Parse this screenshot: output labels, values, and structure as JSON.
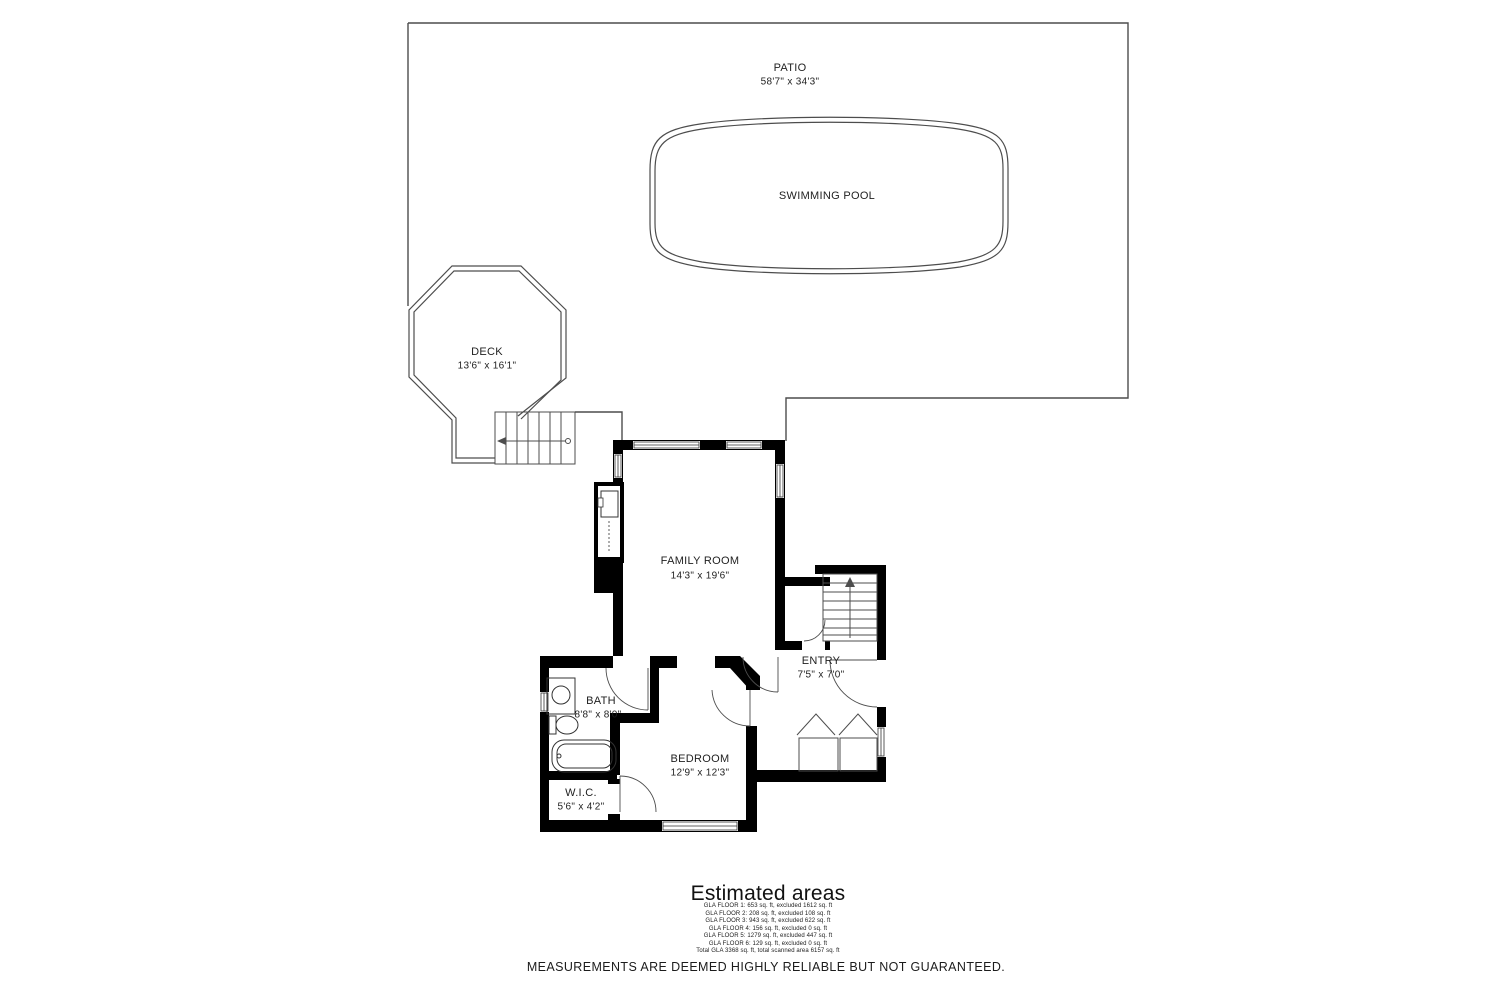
{
  "plan": {
    "patio": {
      "name": "PATIO",
      "dims": "58'7\" x 34'3\""
    },
    "pool": {
      "name": "SWIMMING POOL"
    },
    "deck": {
      "name": "DECK",
      "dims": "13'6\" x 16'1\""
    },
    "family_room": {
      "name": "FAMILY ROOM",
      "dims": "14'3\" x 19'6\""
    },
    "entry": {
      "name": "ENTRY",
      "dims": "7'5\" x 7'0\""
    },
    "bath": {
      "name": "BATH",
      "dims": "8'8\" x 8'0\""
    },
    "bedroom": {
      "name": "BEDROOM",
      "dims": "12'9\" x 12'3\""
    },
    "wic": {
      "name": "W.I.C.",
      "dims": "5'6\" x 4'2\""
    }
  },
  "estimated_areas": {
    "title": "Estimated areas",
    "lines": [
      "GLA FLOOR 1: 653 sq. ft, excluded 1612 sq. ft",
      "GLA FLOOR 2: 208 sq. ft, excluded 108 sq. ft",
      "GLA FLOOR 3: 943 sq. ft, excluded 622 sq. ft",
      "GLA FLOOR 4: 156 sq. ft, excluded 0 sq. ft",
      "GLA FLOOR 5: 1279 sq. ft, excluded 447 sq. ft",
      "GLA FLOOR 6: 129 sq. ft, excluded 0 sq. ft",
      "Total GLA 3368 sq. ft, total scanned area 6157 sq. ft"
    ]
  },
  "disclaimer": "MEASUREMENTS ARE DEEMED HIGHLY RELIABLE BUT NOT GUARANTEED.",
  "colors": {
    "wall": "#000000",
    "outline": "#4d4d4d",
    "text": "#222222"
  }
}
